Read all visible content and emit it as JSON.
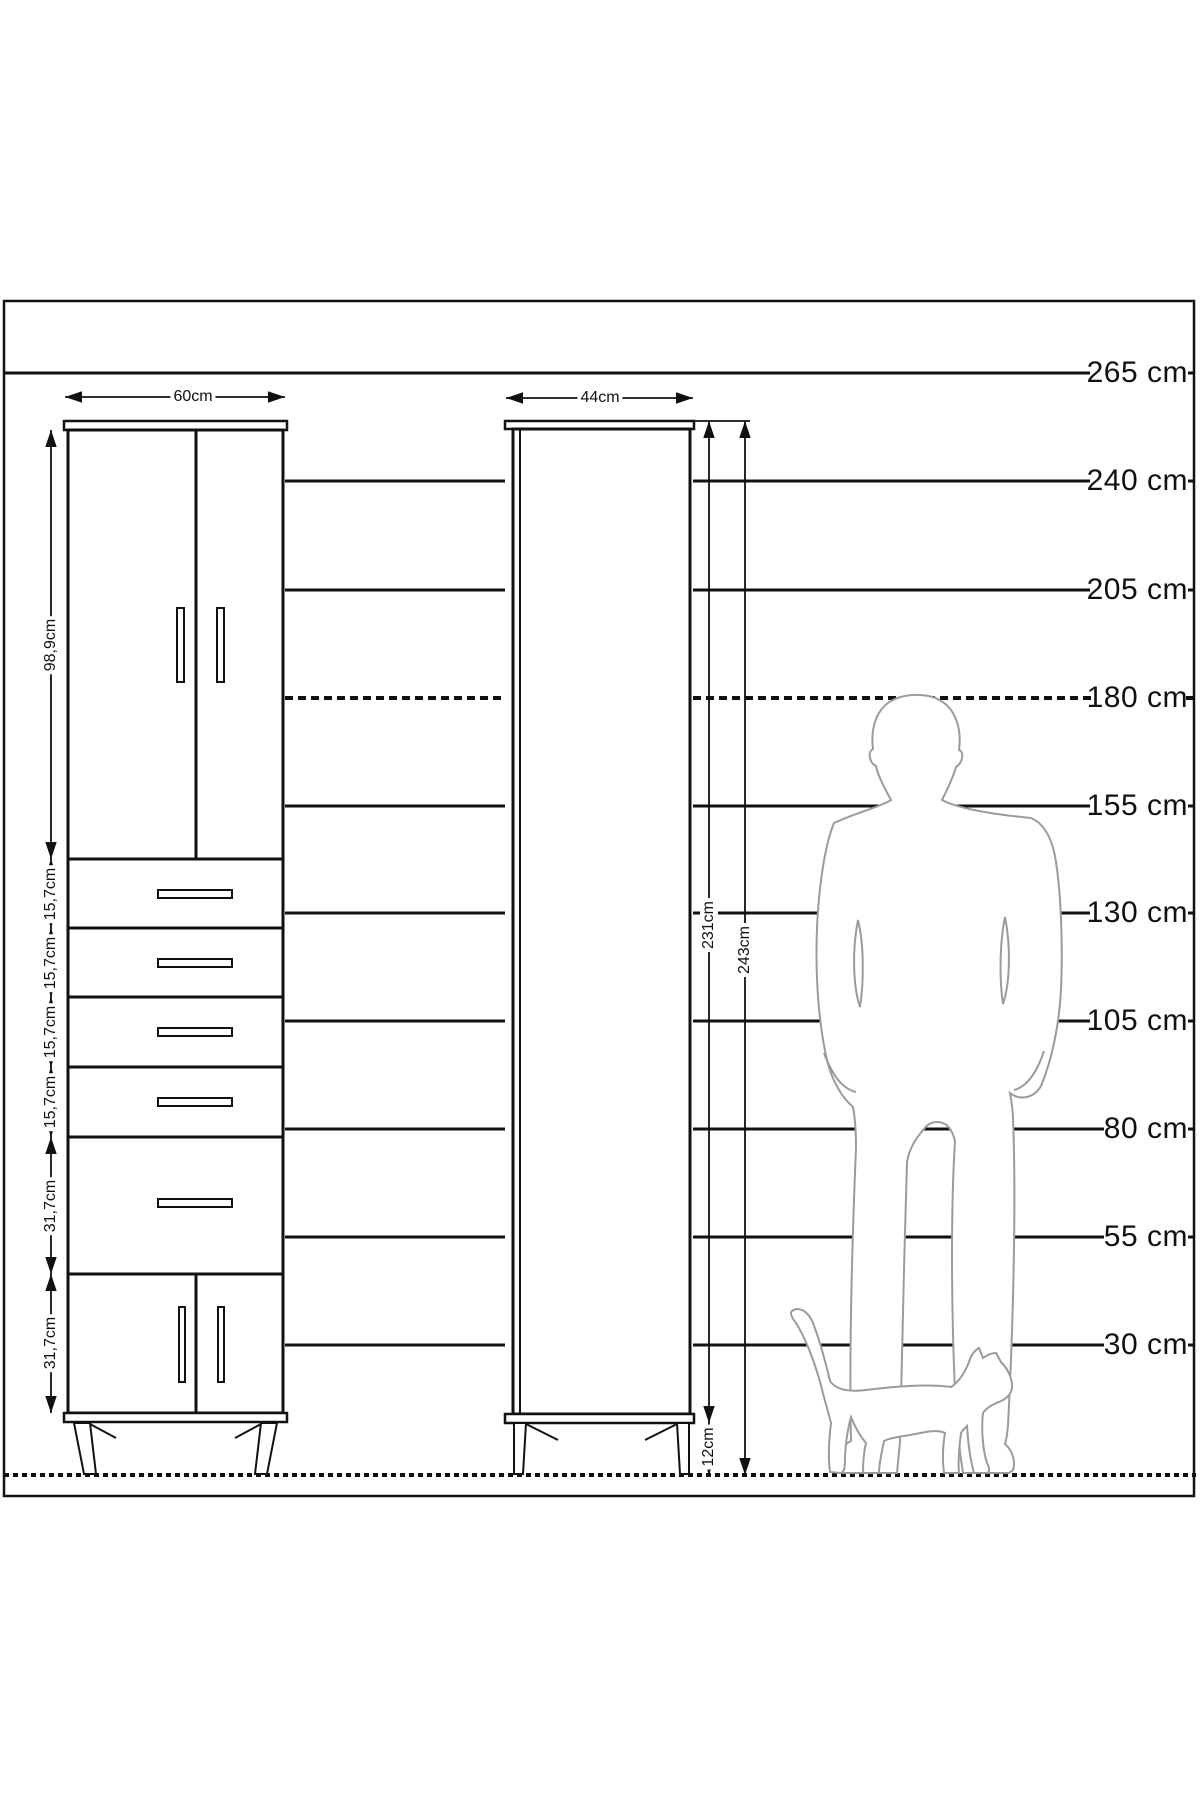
{
  "colors": {
    "line": "#111111",
    "silhouette": "#9b9b9b",
    "background": "#ffffff"
  },
  "ruler_labels": [
    "265 cm",
    "240 cm",
    "205 cm",
    "180 cm",
    "155 cm",
    "130 cm",
    "105 cm",
    "80 cm",
    "55 cm",
    "30 cm"
  ],
  "left_cabinet": {
    "width": "60cm",
    "upper_doors_height": "98,9cm",
    "drawer_heights": [
      "15,7cm",
      "15,7cm",
      "15,7cm",
      "15,7cm"
    ],
    "big_drawer_height": "31,7cm",
    "lower_doors_height": "31,7cm"
  },
  "right_cabinet": {
    "width": "44cm",
    "body_height": "231cm",
    "total_height": "243cm",
    "leg_height": "12cm"
  }
}
